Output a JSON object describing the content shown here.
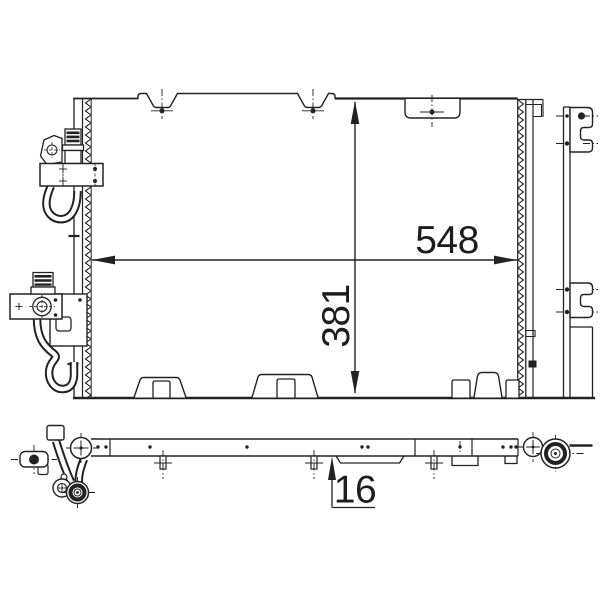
{
  "meta": {
    "background_color": "#ffffff",
    "ink_color": "#222222",
    "drawing_type": "technical-line-drawing",
    "subject": "condenser-with-front-and-side-view"
  },
  "dimensions": {
    "width": {
      "value": "548"
    },
    "height": {
      "value": "381"
    },
    "depth": {
      "value": "16"
    }
  }
}
